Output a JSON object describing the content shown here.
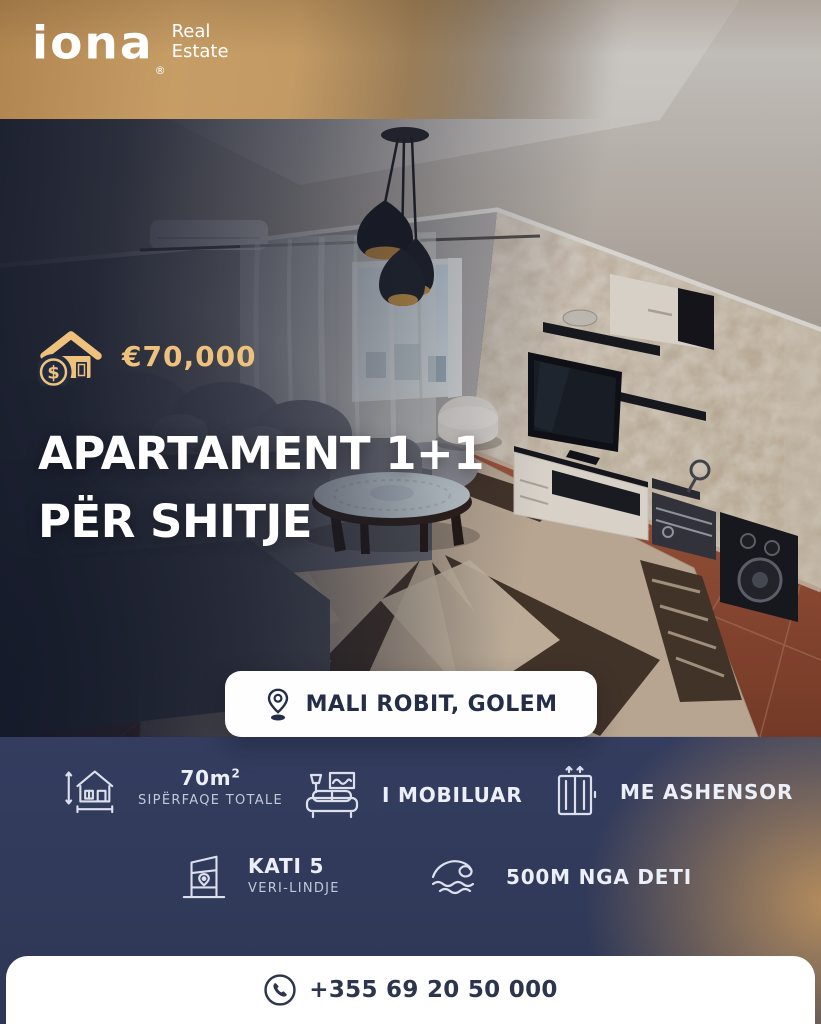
{
  "brand": {
    "logo_text": "iona",
    "registered_mark": "®",
    "tagline_line1": "Real",
    "tagline_line2": "Estate"
  },
  "price": {
    "value": "€70,000"
  },
  "title": {
    "line1": "APARTAMENT 1+1",
    "line2": "PËR SHITJE"
  },
  "location": {
    "label": "MALI ROBIT, GOLEM"
  },
  "features": [
    {
      "value": "70m",
      "value_sup": "2",
      "label": "SIPËRFAQE TOTALE"
    },
    {
      "value": "I MOBILUAR",
      "label": ""
    },
    {
      "value": "ME ASHENSOR",
      "label": ""
    },
    {
      "value": "KATI 5",
      "label": "VERI-LINDJE"
    },
    {
      "value": "500M NGA DETI",
      "label": ""
    }
  ],
  "contact": {
    "phone": "+355 69 20 50 000"
  },
  "colors": {
    "navy": "#313a5a",
    "gold_text": "#eec27d",
    "band_gold": "#c79d66",
    "pill_text": "#252e49",
    "white": "#ffffff"
  }
}
